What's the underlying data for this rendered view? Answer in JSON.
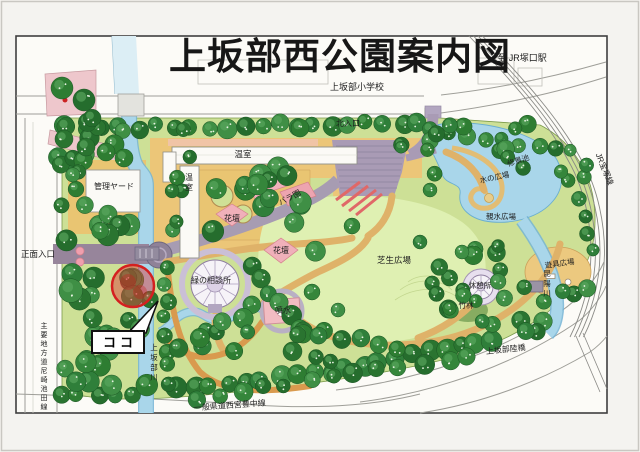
{
  "title": {
    "text": "上坂部西公園案内図"
  },
  "marker": {
    "label": "ココ"
  },
  "colors": {
    "marker_red": "#d42020",
    "water": "#a9d6ea",
    "tree_green": "#2e7d32",
    "path_tan": "#dfb269",
    "plaza_purple": "#a99bb5",
    "flower_pink": "#f0b0ba",
    "lawn": "#dff0b2",
    "park_green": "#cde096"
  },
  "map_labels": [
    {
      "id": "school",
      "text": "上坂部小学校",
      "x": 357,
      "y": 90,
      "size": 9
    },
    {
      "id": "to-jr-tsukaguchi",
      "text": "至 JR塚口駅",
      "x": 522,
      "y": 61,
      "size": 9
    },
    {
      "id": "jr-takarazuka-line",
      "text": "JR宝塚線",
      "x": 602,
      "y": 170,
      "size": 8,
      "rotate": 68
    },
    {
      "id": "north-entrance",
      "text": "北入口",
      "x": 348,
      "y": 126,
      "size": 8
    },
    {
      "id": "management-yard",
      "text": "管理ヤード",
      "x": 114,
      "y": 189,
      "size": 8
    },
    {
      "id": "greenhouse-long",
      "text": "温室",
      "x": 243,
      "y": 157,
      "size": 8.5
    },
    {
      "id": "greenhouse-tall",
      "text": "温室",
      "x": 189,
      "y": 180,
      "size": 8,
      "vertical": true
    },
    {
      "id": "rose-garden",
      "text": "バラ園",
      "x": 291,
      "y": 200,
      "size": 8,
      "rotate": -28
    },
    {
      "id": "flowerbed-west",
      "text": "花壇",
      "x": 232,
      "y": 221,
      "size": 8
    },
    {
      "id": "flowerbed-center",
      "text": "花壇",
      "x": 281,
      "y": 253,
      "size": 8
    },
    {
      "id": "lawn-plaza",
      "text": "芝生広場",
      "x": 394,
      "y": 263,
      "size": 8.5
    },
    {
      "id": "green-consultation",
      "text": "緑の相談所",
      "x": 211,
      "y": 283,
      "size": 8
    },
    {
      "id": "fountain",
      "text": "噴水",
      "x": 283,
      "y": 313,
      "size": 8
    },
    {
      "id": "scenic-pond",
      "text": "修景池",
      "x": 519,
      "y": 163,
      "size": 7.5,
      "rotate": -18
    },
    {
      "id": "water-plaza",
      "text": "水の広場",
      "x": 495,
      "y": 180,
      "size": 7.5,
      "rotate": -12
    },
    {
      "id": "shinsui-plaza",
      "text": "親水広場",
      "x": 501,
      "y": 219,
      "size": 7.5
    },
    {
      "id": "playground-plaza",
      "text": "遊具広場",
      "x": 560,
      "y": 266,
      "size": 7.5,
      "rotate": -8
    },
    {
      "id": "rest-house",
      "text": "休憩所",
      "x": 480,
      "y": 288,
      "size": 7.5
    },
    {
      "id": "bamboo-grove",
      "text": "竹林",
      "x": 466,
      "y": 308,
      "size": 7.5
    },
    {
      "id": "koya-river",
      "text": "昆陽川",
      "x": 547,
      "y": 276,
      "size": 7.5,
      "vertical": true
    },
    {
      "id": "kamisakabe-river",
      "text": "上坂部川",
      "x": 154,
      "y": 350,
      "size": 7.5,
      "vertical": true
    },
    {
      "id": "overpass",
      "text": "上坂部陸橋",
      "x": 506,
      "y": 352,
      "size": 8,
      "rotate": -6
    },
    {
      "id": "main-entrance",
      "text": "正面入口",
      "x": 38,
      "y": 257,
      "size": 8.5
    },
    {
      "id": "pref-road-amagasaki-ikeda",
      "text": "主要地方道尼崎池田線",
      "x": 44,
      "y": 328,
      "size": 7,
      "vertical": true
    },
    {
      "id": "pref-road-nishinomiya-toyonaka",
      "text": "一般県道西宮豊中線",
      "x": 230,
      "y": 408,
      "size": 8,
      "rotate": -4
    }
  ]
}
